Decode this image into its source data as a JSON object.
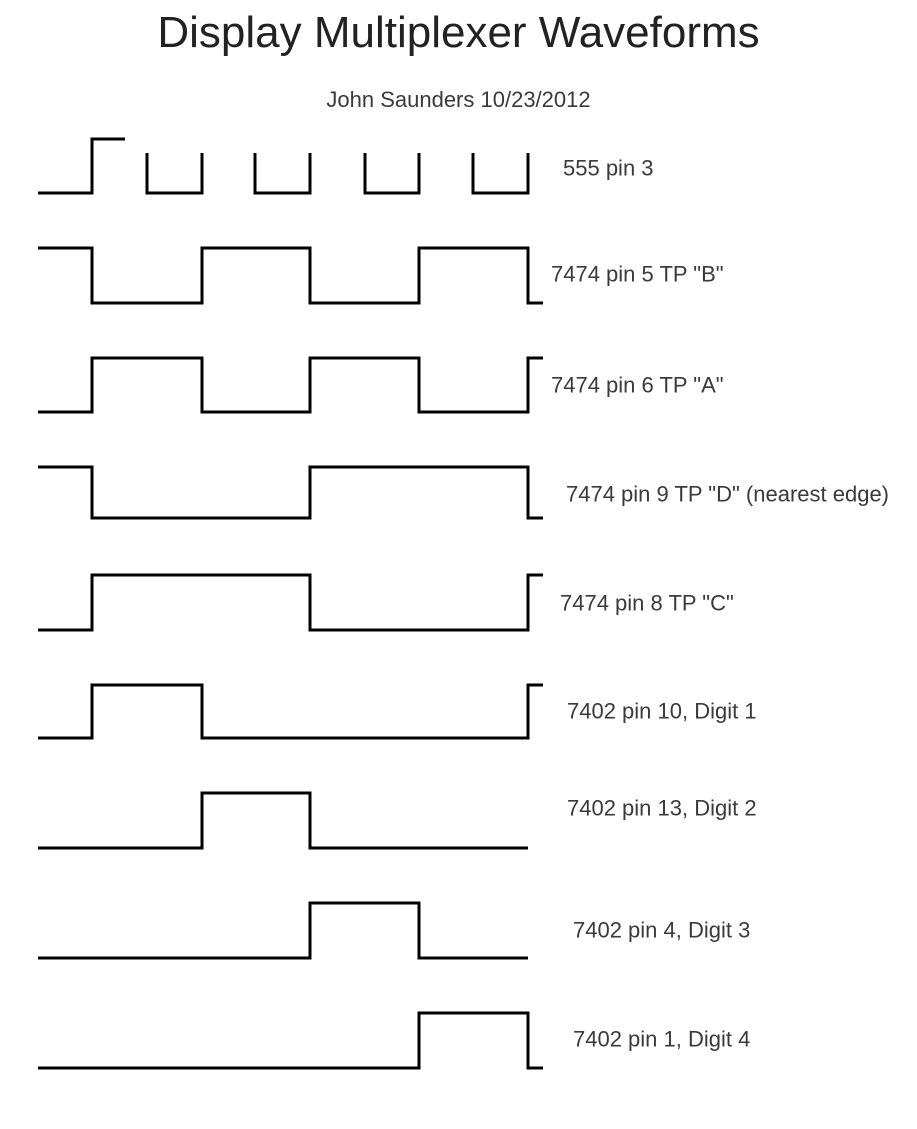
{
  "page": {
    "title": "Display Multiplexer Waveforms",
    "subtitle": "John Saunders 10/23/2012",
    "background_color": "#ffffff",
    "trace_color": "#000000",
    "label_color": "#3a3a3a",
    "trace_stroke_width": 3
  },
  "chart_data": {
    "type": "line",
    "subtype": "digital-timing-diagram",
    "title": "Display Multiplexer Waveforms",
    "subtitle": "John Saunders 10/23/2012",
    "xlabel": "",
    "ylabel": "",
    "grid": false,
    "legend_position": "right-of-each-trace",
    "description": "Nine digital logic waveforms drawn as square traces; high/low levels in page pixel coordinates, x increasing with time.",
    "waveforms": [
      {
        "label": "555 pin 3",
        "label_x": 563,
        "label_y": 168,
        "high_y": 153,
        "low_y": 193,
        "segments": [
          [
            [
              38,
              193
            ],
            [
              92,
              193
            ],
            [
              92,
              139
            ],
            [
              125,
              139
            ]
          ],
          [
            [
              147,
              153
            ],
            [
              147,
              193
            ],
            [
              202,
              193
            ],
            [
              202,
              153
            ]
          ],
          [
            [
              255,
              153
            ],
            [
              255,
              193
            ],
            [
              310,
              193
            ],
            [
              310,
              153
            ]
          ],
          [
            [
              365,
              153
            ],
            [
              365,
              193
            ],
            [
              419,
              193
            ],
            [
              419,
              153
            ]
          ],
          [
            [
              473,
              153
            ],
            [
              473,
              193
            ],
            [
              528,
              193
            ],
            [
              528,
              153
            ]
          ]
        ]
      },
      {
        "label": "7474 pin 5 TP \"B\"",
        "label_x": 551,
        "label_y": 274,
        "high_y": 248,
        "low_y": 303,
        "segments": [
          [
            [
              38,
              248
            ],
            [
              92,
              248
            ],
            [
              92,
              303
            ],
            [
              202,
              303
            ],
            [
              202,
              248
            ],
            [
              310,
              248
            ],
            [
              310,
              303
            ],
            [
              419,
              303
            ],
            [
              419,
              248
            ],
            [
              528,
              248
            ],
            [
              528,
              303
            ],
            [
              543,
              303
            ]
          ]
        ]
      },
      {
        "label": "7474 pin 6 TP \"A\"",
        "label_x": 551,
        "label_y": 385,
        "high_y": 358,
        "low_y": 412,
        "segments": [
          [
            [
              38,
              412
            ],
            [
              92,
              412
            ],
            [
              92,
              358
            ],
            [
              202,
              358
            ],
            [
              202,
              412
            ],
            [
              310,
              412
            ],
            [
              310,
              358
            ],
            [
              419,
              358
            ],
            [
              419,
              412
            ],
            [
              528,
              412
            ],
            [
              528,
              358
            ],
            [
              543,
              358
            ]
          ]
        ]
      },
      {
        "label": "7474 pin 9 TP \"D\" (nearest edge)",
        "label_x": 566,
        "label_y": 494,
        "high_y": 467,
        "low_y": 518,
        "segments": [
          [
            [
              38,
              467
            ],
            [
              92,
              467
            ],
            [
              92,
              518
            ],
            [
              310,
              518
            ],
            [
              310,
              467
            ],
            [
              528,
              467
            ],
            [
              528,
              518
            ],
            [
              543,
              518
            ]
          ]
        ]
      },
      {
        "label": "7474 pin 8 TP \"C\"",
        "label_x": 560,
        "label_y": 603,
        "high_y": 575,
        "low_y": 630,
        "segments": [
          [
            [
              38,
              630
            ],
            [
              92,
              630
            ],
            [
              92,
              575
            ],
            [
              310,
              575
            ],
            [
              310,
              630
            ],
            [
              528,
              630
            ],
            [
              528,
              575
            ],
            [
              543,
              575
            ]
          ]
        ]
      },
      {
        "label": "7402 pin 10, Digit 1",
        "label_x": 567,
        "label_y": 711,
        "high_y": 685,
        "low_y": 738,
        "segments": [
          [
            [
              38,
              738
            ],
            [
              92,
              738
            ],
            [
              92,
              685
            ],
            [
              202,
              685
            ],
            [
              202,
              738
            ],
            [
              528,
              738
            ],
            [
              528,
              685
            ],
            [
              543,
              685
            ]
          ]
        ]
      },
      {
        "label": "7402 pin 13, Digit 2",
        "label_x": 567,
        "label_y": 808,
        "high_y": 793,
        "low_y": 848,
        "segments": [
          [
            [
              38,
              848
            ],
            [
              202,
              848
            ],
            [
              202,
              793
            ],
            [
              310,
              793
            ],
            [
              310,
              848
            ],
            [
              528,
              848
            ]
          ]
        ]
      },
      {
        "label": "7402 pin 4, Digit 3",
        "label_x": 573,
        "label_y": 930,
        "high_y": 903,
        "low_y": 958,
        "segments": [
          [
            [
              38,
              958
            ],
            [
              310,
              958
            ],
            [
              310,
              903
            ],
            [
              419,
              903
            ],
            [
              419,
              958
            ],
            [
              528,
              958
            ]
          ]
        ]
      },
      {
        "label": "7402 pin 1, Digit 4",
        "label_x": 573,
        "label_y": 1039,
        "high_y": 1013,
        "low_y": 1068,
        "segments": [
          [
            [
              38,
              1068
            ],
            [
              419,
              1068
            ],
            [
              419,
              1013
            ],
            [
              528,
              1013
            ],
            [
              528,
              1068
            ],
            [
              543,
              1068
            ]
          ]
        ]
      }
    ]
  }
}
